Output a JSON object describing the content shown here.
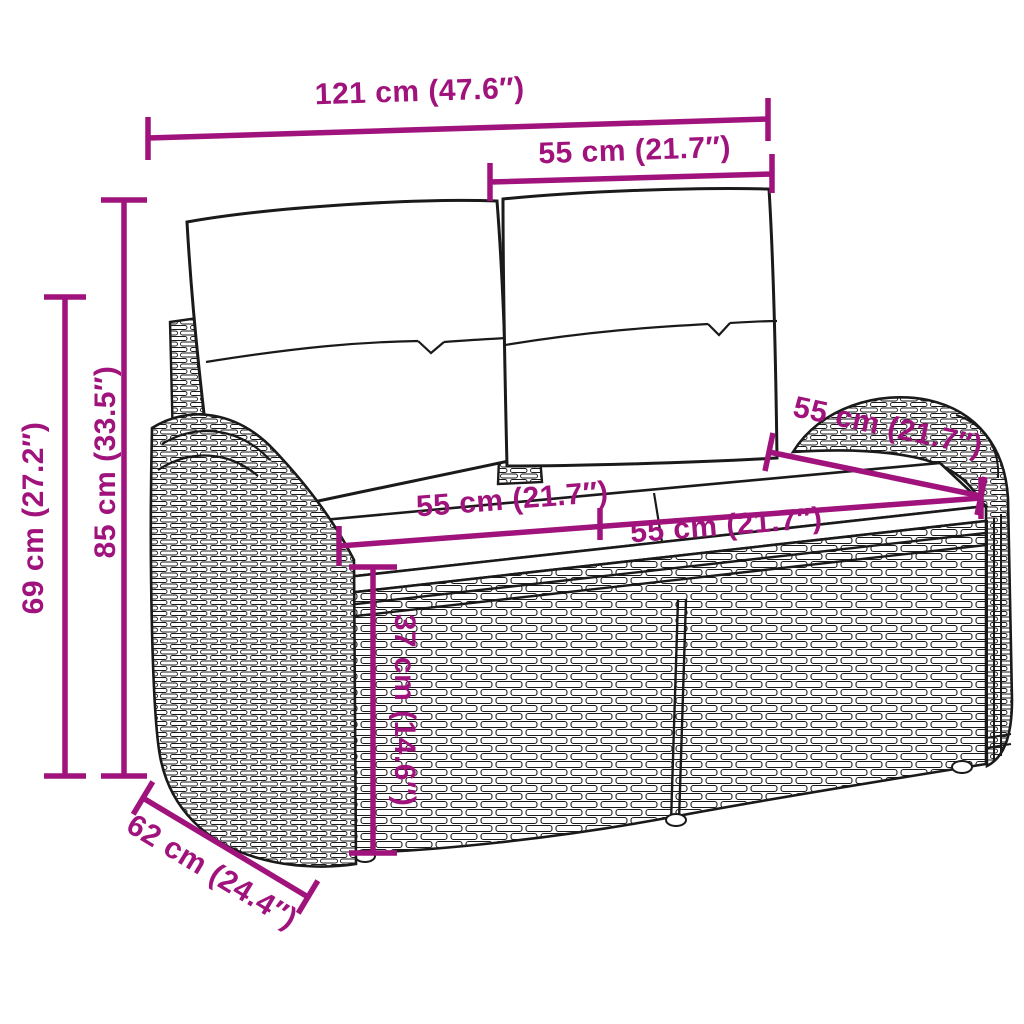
{
  "colors": {
    "accent": "#A0127C",
    "ink": "#1a1a1a",
    "background": "#ffffff",
    "cushion_fill": "#ffffff"
  },
  "dimensions": {
    "total_width": {
      "label": "121 cm (47.6″)"
    },
    "back_width": {
      "label": "55 cm (21.7″)"
    },
    "total_height": {
      "label": "85 cm (33.5″)"
    },
    "side_height": {
      "label": "69 cm (27.2″)"
    },
    "seat_left_width": {
      "label": "55 cm (21.7″)"
    },
    "seat_right_width": {
      "label": "55 cm (21.7″)"
    },
    "seat_depth": {
      "label": "55 cm (21.7″)"
    },
    "seat_height": {
      "label": "37 cm (14.6″)"
    },
    "total_depth": {
      "label": "62 cm (24.4″)"
    }
  }
}
